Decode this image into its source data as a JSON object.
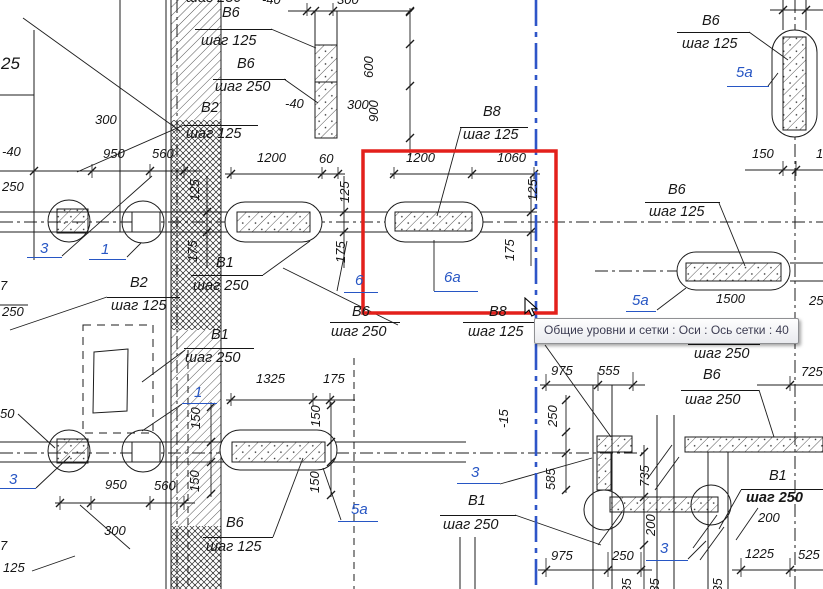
{
  "app": {
    "type": "cad-reinforcement-drawing"
  },
  "tooltip": {
    "text": "Общие уровни и сетки : Оси : Ось сетки : 40"
  },
  "colors": {
    "line": "#1c1c1c",
    "ref_blue": "#2756c4",
    "axis_blue": "#2e55c8",
    "selection_red": "#e3201b"
  },
  "selected_axis": {
    "name": "Ось сетки : 40"
  },
  "labels": [
    {
      "t": "шаг 250",
      "x": 186,
      "y": -9,
      "cls": "step"
    },
    {
      "t": "В6",
      "x": 222,
      "y": 6,
      "cls": "step"
    },
    {
      "t": "шаг 125",
      "x": 201,
      "y": 34,
      "cls": "step"
    },
    {
      "t": "В6",
      "x": 237,
      "y": 57,
      "cls": "step"
    },
    {
      "t": "шаг 250",
      "x": 215,
      "y": 80,
      "cls": "step"
    },
    {
      "t": "В2",
      "x": 201,
      "y": 101,
      "cls": "step"
    },
    {
      "t": "шаг 125",
      "x": 186,
      "y": 127,
      "cls": "step"
    },
    {
      "t": "-40",
      "x": 262,
      "y": -7,
      "cls": "dim"
    },
    {
      "t": "300",
      "x": 337,
      "y": -7,
      "cls": "dim"
    },
    {
      "t": "-40",
      "x": 285,
      "y": 97,
      "cls": "dim"
    },
    {
      "t": "300",
      "x": 347,
      "y": 98,
      "cls": "dim"
    },
    {
      "t": "600",
      "x": 362,
      "y": 78,
      "cls": "dimv"
    },
    {
      "t": "900",
      "x": 367,
      "y": 122,
      "cls": "dimv"
    },
    {
      "t": "300",
      "x": 95,
      "y": 113,
      "cls": "dim"
    },
    {
      "t": "950",
      "x": 103,
      "y": 147,
      "cls": "dim"
    },
    {
      "t": "560",
      "x": 152,
      "y": 147,
      "cls": "dim"
    },
    {
      "t": "25",
      "x": 1,
      "y": 55,
      "cls": "big"
    },
    {
      "t": "-40",
      "x": 2,
      "y": 145,
      "cls": "dim"
    },
    {
      "t": "250",
      "x": 2,
      "y": 180,
      "cls": "dim"
    },
    {
      "t": "1200",
      "x": 257,
      "y": 151,
      "cls": "dim"
    },
    {
      "t": "60",
      "x": 319,
      "y": 152,
      "cls": "dim"
    },
    {
      "t": "1200",
      "x": 406,
      "y": 151,
      "cls": "dim"
    },
    {
      "t": "1060",
      "x": 497,
      "y": 151,
      "cls": "dim"
    },
    {
      "t": "В8",
      "x": 483,
      "y": 105,
      "cls": "step"
    },
    {
      "t": "шаг 125",
      "x": 463,
      "y": 128,
      "cls": "step"
    },
    {
      "t": "125",
      "x": 188,
      "y": 201,
      "cls": "dimv"
    },
    {
      "t": "175",
      "x": 186,
      "y": 262,
      "cls": "dimv"
    },
    {
      "t": "125",
      "x": 338,
      "y": 203,
      "cls": "dimv"
    },
    {
      "t": "175",
      "x": 334,
      "y": 263,
      "cls": "dimv"
    },
    {
      "t": "125",
      "x": 526,
      "y": 201,
      "cls": "dimv"
    },
    {
      "t": "175",
      "x": 503,
      "y": 261,
      "cls": "dimv"
    },
    {
      "t": "В1",
      "x": 216,
      "y": 256,
      "cls": "step"
    },
    {
      "t": "шаг 250",
      "x": 193,
      "y": 279,
      "cls": "step"
    },
    {
      "t": "В1",
      "x": 211,
      "y": 328,
      "cls": "step"
    },
    {
      "t": "шаг 250",
      "x": 185,
      "y": 351,
      "cls": "step"
    },
    {
      "t": "6",
      "x": 355,
      "y": 273,
      "cls": "ref"
    },
    {
      "t": "6а",
      "x": 444,
      "y": 270,
      "cls": "ref"
    },
    {
      "t": "В6",
      "x": 352,
      "y": 305,
      "cls": "step"
    },
    {
      "t": "шаг 250",
      "x": 331,
      "y": 325,
      "cls": "step"
    },
    {
      "t": "В8",
      "x": 489,
      "y": 305,
      "cls": "step"
    },
    {
      "t": "шаг 125",
      "x": 468,
      "y": 325,
      "cls": "step"
    },
    {
      "t": "В2",
      "x": 130,
      "y": 276,
      "cls": "step"
    },
    {
      "t": "шаг 125",
      "x": 111,
      "y": 299,
      "cls": "step"
    },
    {
      "t": "3",
      "x": 40,
      "y": 241,
      "cls": "ref"
    },
    {
      "t": "1",
      "x": 101,
      "y": 242,
      "cls": "ref"
    },
    {
      "t": "7",
      "x": 0,
      "y": 279,
      "cls": "dim"
    },
    {
      "t": "250",
      "x": 2,
      "y": 305,
      "cls": "dim"
    },
    {
      "t": "50",
      "x": 0,
      "y": 407,
      "cls": "dim"
    },
    {
      "t": "3",
      "x": 9,
      "y": 472,
      "cls": "ref"
    },
    {
      "t": "950",
      "x": 105,
      "y": 478,
      "cls": "dim"
    },
    {
      "t": "560",
      "x": 154,
      "y": 479,
      "cls": "dim"
    },
    {
      "t": "300",
      "x": 104,
      "y": 524,
      "cls": "dim"
    },
    {
      "t": "7",
      "x": 0,
      "y": 539,
      "cls": "dim"
    },
    {
      "t": "125",
      "x": 3,
      "y": 561,
      "cls": "dim"
    },
    {
      "t": "1325",
      "x": 256,
      "y": 372,
      "cls": "dim"
    },
    {
      "t": "175",
      "x": 323,
      "y": 372,
      "cls": "dim"
    },
    {
      "t": "1",
      "x": 194,
      "y": 385,
      "cls": "ref"
    },
    {
      "t": "150",
      "x": 189,
      "y": 429,
      "cls": "dimv"
    },
    {
      "t": "150",
      "x": 188,
      "y": 492,
      "cls": "dimv"
    },
    {
      "t": "150",
      "x": 309,
      "y": 427,
      "cls": "dimv"
    },
    {
      "t": "150",
      "x": 308,
      "y": 493,
      "cls": "dimv"
    },
    {
      "t": "В6",
      "x": 226,
      "y": 516,
      "cls": "step"
    },
    {
      "t": "шаг 125",
      "x": 206,
      "y": 540,
      "cls": "step"
    },
    {
      "t": "5а",
      "x": 351,
      "y": 502,
      "cls": "ref"
    },
    {
      "t": "В6",
      "x": 702,
      "y": 14,
      "cls": "step"
    },
    {
      "t": "шаг 125",
      "x": 682,
      "y": 37,
      "cls": "step"
    },
    {
      "t": "5а",
      "x": 736,
      "y": 65,
      "cls": "ref"
    },
    {
      "t": "150",
      "x": 752,
      "y": 147,
      "cls": "dim"
    },
    {
      "t": "150",
      "x": 816,
      "y": 147,
      "cls": "dim"
    },
    {
      "t": "В6",
      "x": 668,
      "y": 183,
      "cls": "step"
    },
    {
      "t": "шаг 125",
      "x": 649,
      "y": 205,
      "cls": "step"
    },
    {
      "t": "1500",
      "x": 716,
      "y": 292,
      "cls": "dim"
    },
    {
      "t": "250",
      "x": 809,
      "y": 294,
      "cls": "dim"
    },
    {
      "t": "5а",
      "x": 632,
      "y": 293,
      "cls": "ref"
    },
    {
      "t": "975",
      "x": 551,
      "y": 364,
      "cls": "dim"
    },
    {
      "t": "555",
      "x": 598,
      "y": 364,
      "cls": "dim"
    },
    {
      "t": "725",
      "x": 801,
      "y": 365,
      "cls": "dim"
    },
    {
      "t": "-15",
      "x": 497,
      "y": 428,
      "cls": "dimv"
    },
    {
      "t": "250",
      "x": 546,
      "y": 427,
      "cls": "dimv"
    },
    {
      "t": "585",
      "x": 544,
      "y": 490,
      "cls": "dimv"
    },
    {
      "t": "3",
      "x": 471,
      "y": 465,
      "cls": "ref"
    },
    {
      "t": "В1",
      "x": 468,
      "y": 494,
      "cls": "step"
    },
    {
      "t": "шаг 250",
      "x": 443,
      "y": 518,
      "cls": "step"
    },
    {
      "t": "735",
      "x": 638,
      "y": 487,
      "cls": "dimv"
    },
    {
      "t": "200",
      "x": 644,
      "y": 536,
      "cls": "dimv"
    },
    {
      "t": "235",
      "x": 620,
      "y": 600,
      "cls": "dimv"
    },
    {
      "t": "235",
      "x": 648,
      "y": 600,
      "cls": "dimv"
    },
    {
      "t": "975",
      "x": 551,
      "y": 549,
      "cls": "dim"
    },
    {
      "t": "250",
      "x": 612,
      "y": 549,
      "cls": "dim"
    },
    {
      "t": "3",
      "x": 660,
      "y": 541,
      "cls": "ref"
    },
    {
      "t": "В6",
      "x": 700,
      "y": 325,
      "cls": "step"
    },
    {
      "t": "шаг 250",
      "x": 694,
      "y": 347,
      "cls": "step"
    },
    {
      "t": "В6",
      "x": 703,
      "y": 368,
      "cls": "step"
    },
    {
      "t": "шаг 250",
      "x": 685,
      "y": 393,
      "cls": "step"
    },
    {
      "t": "В1",
      "x": 769,
      "y": 469,
      "cls": "step"
    },
    {
      "t": "шаг 250",
      "x": 746,
      "y": 491,
      "cls": "stepb"
    },
    {
      "t": "200",
      "x": 758,
      "y": 511,
      "cls": "dim"
    },
    {
      "t": "1225",
      "x": 745,
      "y": 547,
      "cls": "dim"
    },
    {
      "t": "525",
      "x": 798,
      "y": 548,
      "cls": "dim"
    },
    {
      "t": "235",
      "x": 711,
      "y": 600,
      "cls": "dimv"
    }
  ]
}
